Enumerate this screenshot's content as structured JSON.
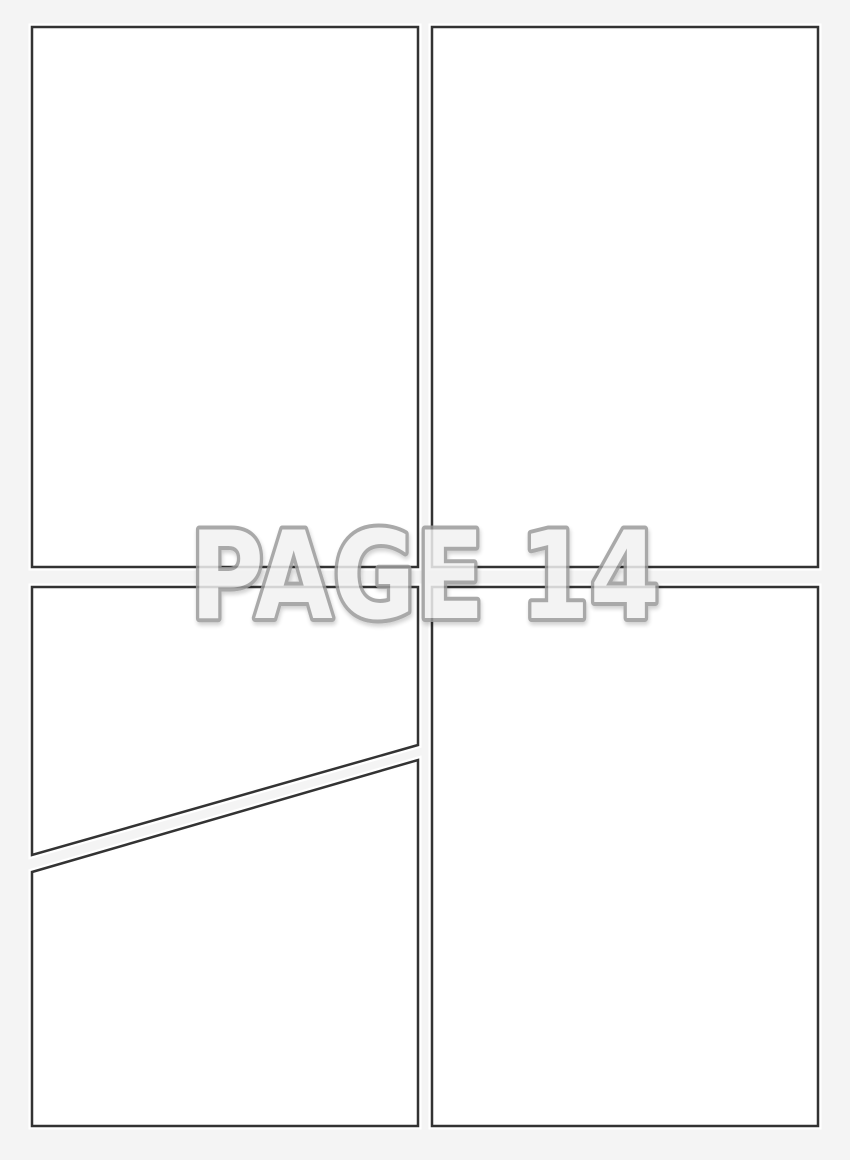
{
  "page": {
    "watermark_label": "PAGE 14",
    "page_number": "14",
    "panel_count": 5,
    "colors": {
      "background": "#f4f4f4",
      "panel_fill": "#ffffff",
      "panel_border": "#333333",
      "panel_halo": "#ffffff",
      "watermark_fill": "#f1f1f1",
      "watermark_outline": "#9b9b9b"
    }
  }
}
